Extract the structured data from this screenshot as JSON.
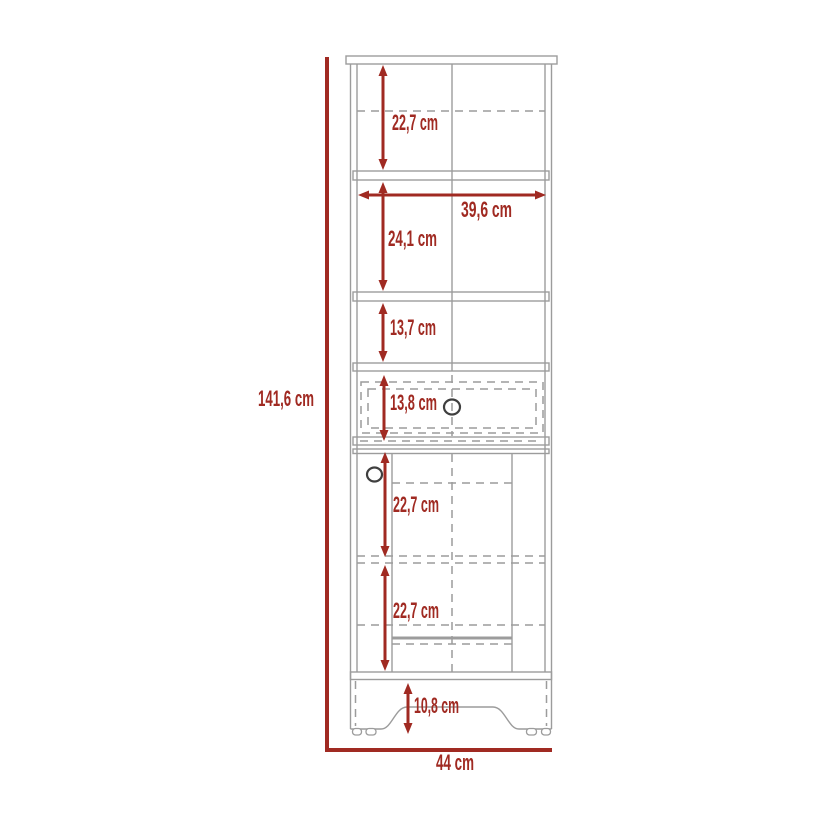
{
  "diagram": {
    "type": "furniture-dimension-diagram",
    "subject": "tall cabinet with three shelves, one drawer and one door",
    "unit": "cm",
    "colors": {
      "dimension": "#A02A22",
      "line": "#9C9C9C",
      "knob": "#3F3F3F",
      "background": "#FFFFFF"
    },
    "labels": {
      "top_section": "22,7 cm",
      "inner_width": "39,6 cm",
      "second_section": "24,1 cm",
      "third_section": "13,7 cm",
      "drawer": "13,8 cm",
      "door_upper": "22,7 cm",
      "door_lower": "22,7 cm",
      "base": "10,8 cm",
      "overall_height": "141,6 cm",
      "overall_width": "44 cm"
    }
  }
}
